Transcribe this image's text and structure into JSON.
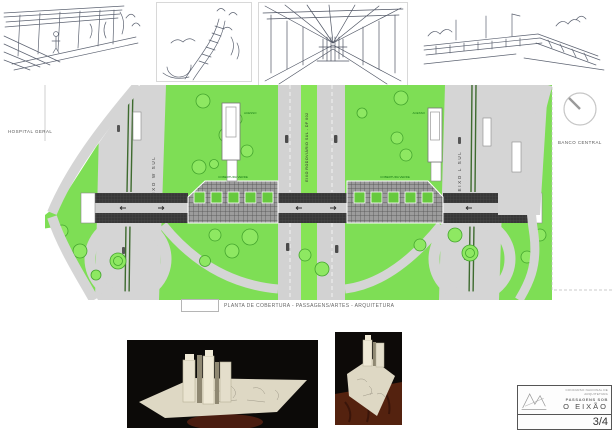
{
  "board": {
    "caption": "PLANTA DE COBERTURA - PASSAGENS/ARTES - ARQUITETURA"
  },
  "plan": {
    "hospital": "HOSPITAL GERAL",
    "banco": "BANCO CENTRAL",
    "road_west": "EIXO W SUL",
    "road_center": "EIXO RODOVIÁRIO SUL - DF 002",
    "road_east": "EIXO L SUL",
    "ann_roof_left": "COBERTURA VERDE",
    "ann_roof_right": "COBERTURA VERDE",
    "ann_access_left": "ACESSO",
    "ann_access_right": "ACESSO"
  },
  "titleblock": {
    "competition": "CONCURSO NACIONAL DE ARQUITETURA",
    "project_line": "PASSAGENS SOB",
    "project_name": "O EIXÃO",
    "sheet": "3/4"
  },
  "colors": {
    "lawn": "#7ede55",
    "road_gray": "#d5d5d5",
    "dark_band": "#3a3a3a",
    "annotation_green": "#157a15",
    "model_cream": "#e6e0cc",
    "table_brown": "#5a2413"
  }
}
